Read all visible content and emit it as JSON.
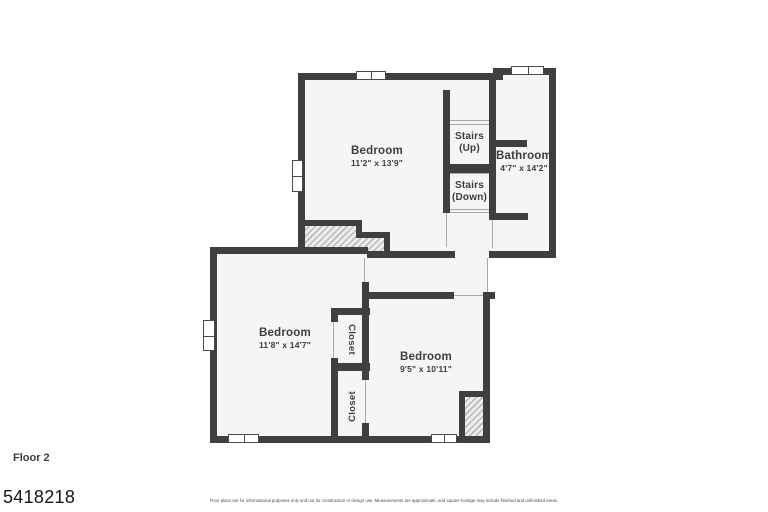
{
  "title": "Floor plan - Floor 2",
  "floor_label": "Floor 2",
  "listing_id": "5418218",
  "disclaimer": "Floor plans are for informational purposes only and not for construction or design use. Measurements are approximate, and square footage may include finished and unfinished areas.",
  "rooms": [
    {
      "name": "Bedroom",
      "dims": "11'2\" x 13'9\""
    },
    {
      "name": "Stairs",
      "dims": "(Up)"
    },
    {
      "name": "Stairs",
      "dims": "(Down)"
    },
    {
      "name": "Bathroom",
      "dims": "4'7\" x 14'2\""
    },
    {
      "name": "Bedroom",
      "dims": "11'8\" x 14'7\""
    },
    {
      "name": "Closet"
    },
    {
      "name": "Bedroom",
      "dims": "9'5\" x 10'11\""
    },
    {
      "name": "Closet"
    }
  ],
  "colors": {
    "wall": "#3f3f41",
    "room_fill": "#f5f5f5",
    "label_text": "#3d3d3d",
    "hatch_stripe": "#b9b9b9",
    "window_frame": "#4a4a4a"
  }
}
